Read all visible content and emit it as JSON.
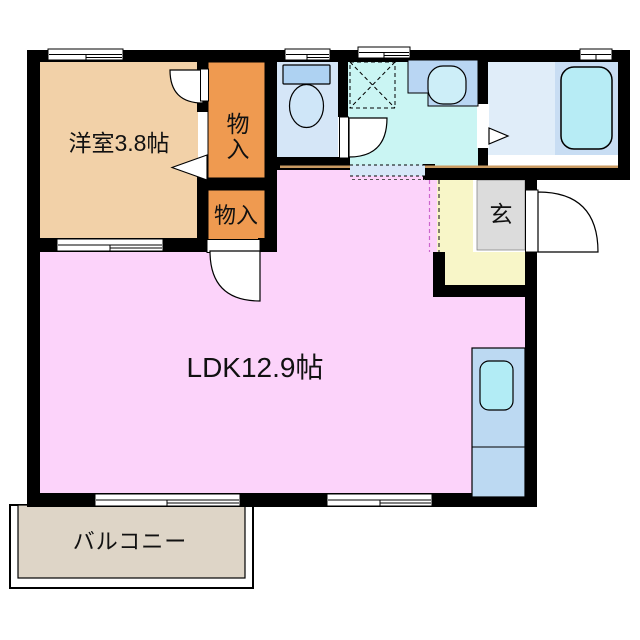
{
  "floorplan": {
    "rooms": {
      "western_room": {
        "label": "洋室3.8帖",
        "color": "#f2d1a8"
      },
      "storage_upper": {
        "label": "物入",
        "color": "#ef9a50"
      },
      "storage_lower": {
        "label": "物入",
        "color": "#ef9a50"
      },
      "ldk": {
        "label": "LDK12.9帖",
        "color": "#fcd3fa"
      },
      "entrance": {
        "label": "玄",
        "floor_color": "#dcdcdc"
      },
      "hall": {
        "color": "#f8f6c8"
      },
      "balcony": {
        "label": "バルコニー",
        "color": "#ded5c7"
      },
      "toilet": {
        "color": "#d5e6f7"
      },
      "washroom": {
        "color": "#caf5f3"
      },
      "bathroom": {
        "color": "#e0edf9"
      }
    },
    "colors": {
      "wall": "#000000",
      "tub_platform": "#c8ddf3",
      "toilet_tank": "#aed2f2",
      "toilet_bowl": "#cfe6f8",
      "vanity_counter": "#b9d6f3",
      "vanity_bowl": "#cdeef8",
      "bathtub": "#b7ecf5",
      "kitchen_counter": "#bcd9f2",
      "kitchen_sink": "#b2ecf5",
      "threshold_line": "#c99a62",
      "open_boundary_strip": "#d6e8f8"
    },
    "icons": {
      "toilet": "toilet-icon",
      "vanity_sink": "sink-icon",
      "washer_space": "washing-machine-space-dashed-box",
      "bathtub": "bathtub-icon",
      "kitchen_sink": "kitchen-sink-icon",
      "doors": "door-swing-arc",
      "folding_door": "folding-door-triangle",
      "windows": "sliding-window-symbol"
    }
  }
}
